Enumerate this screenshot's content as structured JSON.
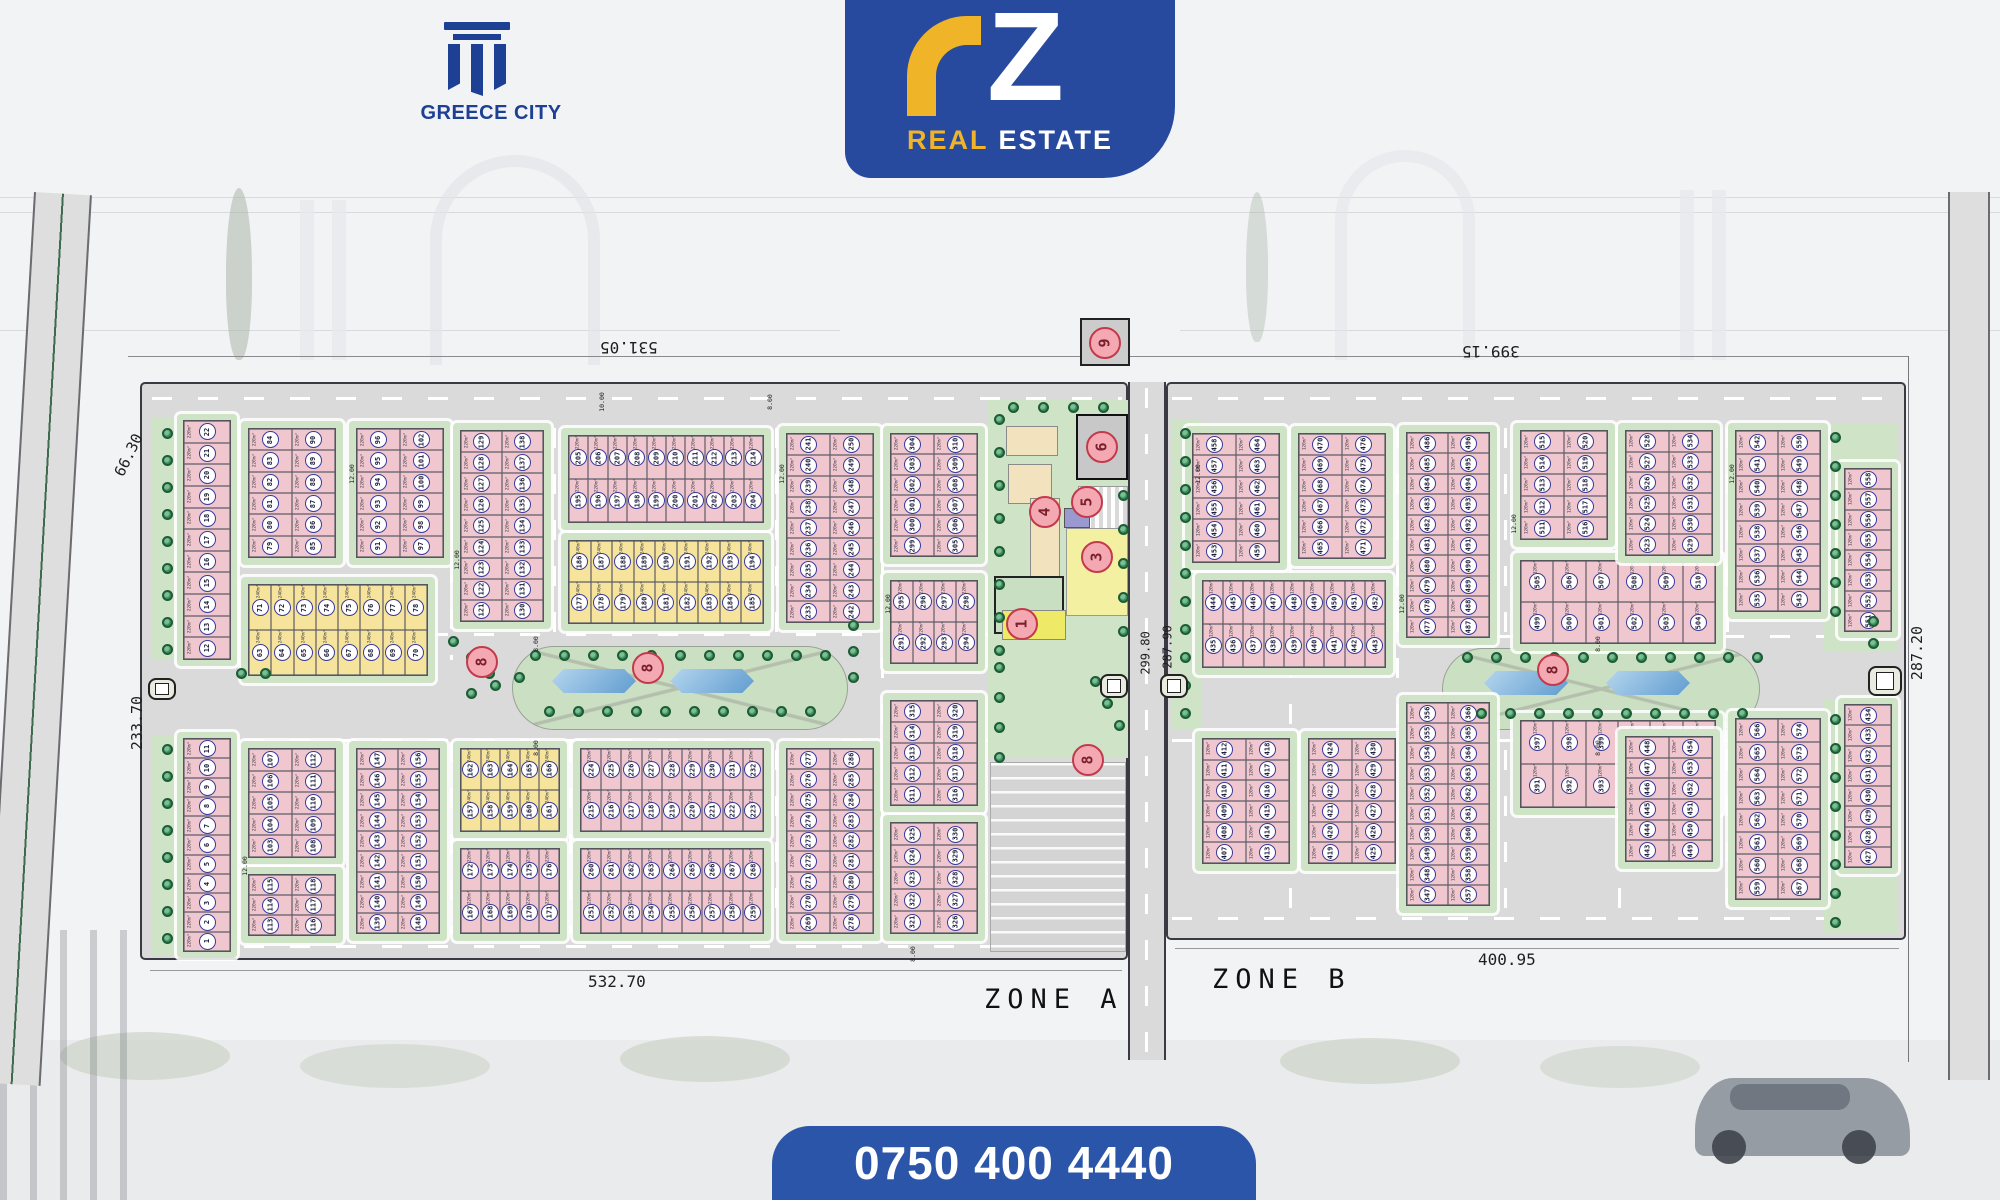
{
  "branding": {
    "developer": "GREECE CITY",
    "rz_z": "Z",
    "rz_real": "REAL",
    "rz_estate": "ESTATE",
    "phone": "0750 400 4440",
    "colors": {
      "brand_blue": "#274a9e",
      "brand_yellow": "#f0b428",
      "plot_pink": "#f1c7cf",
      "plot_yellow": "#f6e49c",
      "green": "#cfe3c6",
      "road": "#dadada",
      "lake_blue": "#5e9bcf",
      "marker_red": "#c23a4b"
    }
  },
  "plan": {
    "zone_labels": [
      {
        "t": "ZONE A",
        "x": 984,
        "y": 984
      },
      {
        "t": "ZONE B",
        "x": 1212,
        "y": 964
      }
    ],
    "dimensions": [
      {
        "t": "531.05",
        "x": 600,
        "y": 338,
        "r": 180,
        "s": 16
      },
      {
        "t": "399.15",
        "x": 1462,
        "y": 342,
        "r": 180,
        "s": 16
      },
      {
        "t": "66.30",
        "x": 106,
        "y": 446,
        "r": -64,
        "s": 15
      },
      {
        "t": "233.70",
        "x": 110,
        "y": 714,
        "r": -90,
        "s": 15
      },
      {
        "t": "287.20",
        "x": 1890,
        "y": 644,
        "r": -90,
        "s": 15
      },
      {
        "t": "299.80",
        "x": 1124,
        "y": 646,
        "r": -90,
        "s": 12
      },
      {
        "t": "287.90",
        "x": 1146,
        "y": 640,
        "r": -90,
        "s": 12
      },
      {
        "t": "532.70",
        "x": 588,
        "y": 972,
        "r": 0,
        "s": 16
      },
      {
        "t": "400.95",
        "x": 1478,
        "y": 950,
        "r": 0,
        "s": 16
      }
    ],
    "road_labels": [
      {
        "t": "10.00",
        "x": 592,
        "y": 398
      },
      {
        "t": "8.00",
        "x": 762,
        "y": 398
      },
      {
        "t": "8.00",
        "x": 528,
        "y": 640
      },
      {
        "t": "8.00",
        "x": 528,
        "y": 744
      },
      {
        "t": "8.00",
        "x": 905,
        "y": 950
      },
      {
        "t": "8.00",
        "x": 1590,
        "y": 640
      },
      {
        "t": "8.00",
        "x": 1590,
        "y": 744
      },
      {
        "t": "12.00",
        "x": 342,
        "y": 470
      },
      {
        "t": "12.00",
        "x": 447,
        "y": 556
      },
      {
        "t": "12.00",
        "x": 772,
        "y": 470
      },
      {
        "t": "12.00",
        "x": 878,
        "y": 600
      },
      {
        "t": "12.00",
        "x": 1188,
        "y": 470
      },
      {
        "t": "12.00",
        "x": 1392,
        "y": 600
      },
      {
        "t": "12.00",
        "x": 1722,
        "y": 470
      },
      {
        "t": "12.00",
        "x": 235,
        "y": 862
      },
      {
        "t": "12.00",
        "x": 1504,
        "y": 520
      }
    ],
    "dashes": [
      {
        "x": 152,
        "y": 397,
        "w": 970
      },
      {
        "x": 1172,
        "y": 397,
        "w": 726
      },
      {
        "x": 152,
        "y": 633,
        "w": 970
      },
      {
        "x": 152,
        "y": 739,
        "w": 970
      },
      {
        "x": 1172,
        "y": 635,
        "w": 726
      },
      {
        "x": 1172,
        "y": 739,
        "w": 726
      },
      {
        "x": 152,
        "y": 945,
        "w": 970
      },
      {
        "x": 1172,
        "y": 917,
        "w": 726
      },
      {
        "x": 1145,
        "y": 388,
        "h": 664,
        "v": 1
      },
      {
        "x": 450,
        "y": 425,
        "h": 235,
        "v": 1
      },
      {
        "x": 450,
        "y": 742,
        "h": 192,
        "v": 1
      },
      {
        "x": 553,
        "y": 428,
        "h": 228,
        "v": 1
      },
      {
        "x": 569,
        "y": 742,
        "h": 192,
        "v": 1
      },
      {
        "x": 775,
        "y": 428,
        "h": 506,
        "v": 1
      },
      {
        "x": 881,
        "y": 428,
        "h": 506,
        "v": 1
      },
      {
        "x": 1289,
        "y": 428,
        "h": 506,
        "v": 1
      },
      {
        "x": 1396,
        "y": 428,
        "h": 506,
        "v": 1
      },
      {
        "x": 1504,
        "y": 428,
        "h": 506,
        "v": 1
      },
      {
        "x": 1618,
        "y": 428,
        "h": 506,
        "v": 1
      },
      {
        "x": 1726,
        "y": 428,
        "h": 506,
        "v": 1
      }
    ],
    "medians": [
      {
        "x": 512,
        "y": 646,
        "w": 336,
        "h": 84,
        "lakes": [
          {
            "x": 552,
            "y": 666,
            "w": 84,
            "h": 30
          },
          {
            "x": 670,
            "y": 666,
            "w": 84,
            "h": 30
          }
        ]
      },
      {
        "x": 1442,
        "y": 648,
        "w": 318,
        "h": 82,
        "lakes": [
          {
            "x": 1484,
            "y": 668,
            "w": 84,
            "h": 30
          },
          {
            "x": 1606,
            "y": 668,
            "w": 84,
            "h": 30
          }
        ]
      }
    ],
    "facilities": [
      {
        "name": "green-strip",
        "x": 152,
        "y": 418,
        "w": 30,
        "h": 242,
        "bg": "#cfe4c7"
      },
      {
        "name": "green-strip",
        "x": 152,
        "y": 736,
        "w": 30,
        "h": 220,
        "bg": "#cfe4c7"
      },
      {
        "name": "green-strip",
        "x": 1172,
        "y": 420,
        "w": 30,
        "h": 310,
        "bg": "#cfe4c7"
      },
      {
        "name": "green-strip",
        "x": 1824,
        "y": 424,
        "w": 74,
        "h": 228,
        "bg": "#cfe4c7"
      },
      {
        "name": "green-strip",
        "x": 1824,
        "y": 700,
        "w": 74,
        "h": 234,
        "bg": "#cfe4c7"
      },
      {
        "name": "services-green",
        "x": 988,
        "y": 400,
        "w": 140,
        "h": 358,
        "bg": "#cfe4c7"
      },
      {
        "name": "parking-area",
        "x": 990,
        "y": 762,
        "w": 136,
        "h": 190,
        "bg": "#d6d6d6",
        "bd": "#aaa",
        "hatch": 1
      },
      {
        "name": "service-building",
        "x": 1006,
        "y": 426,
        "w": 52,
        "h": 30,
        "bg": "#f2e2bd",
        "bd": "#8a8a8a"
      },
      {
        "name": "service-building",
        "x": 1008,
        "y": 464,
        "w": 44,
        "h": 40,
        "bg": "#f2e2bd",
        "bd": "#8a8a8a"
      },
      {
        "name": "service-building",
        "x": 1030,
        "y": 498,
        "w": 30,
        "h": 96,
        "bg": "#f2e2bd",
        "bd": "#8a8a8a"
      },
      {
        "name": "electrical-station",
        "x": 1076,
        "y": 414,
        "w": 52,
        "h": 66,
        "bg": "#c8c8c8",
        "bd": "#111",
        "bw": 2
      },
      {
        "name": "striped-court",
        "x": 1078,
        "y": 486,
        "w": 50,
        "h": 52,
        "bg": "repeating-linear-gradient(90deg,#ffffff 0 4px,#d9d9d9 4px 8px)",
        "bd": "#999"
      },
      {
        "name": "service-building",
        "x": 1064,
        "y": 508,
        "w": 26,
        "h": 20,
        "bg": "#9a9ad0",
        "bd": "#555"
      },
      {
        "name": "service-building",
        "x": 1066,
        "y": 528,
        "w": 62,
        "h": 88,
        "bg": "#f4f0a2",
        "bd": "#999"
      },
      {
        "name": "walled-garden",
        "x": 994,
        "y": 576,
        "w": 70,
        "h": 58,
        "bg": "#c9dfc1",
        "bd": "#222",
        "bw": 2
      },
      {
        "name": "service-building",
        "x": 1002,
        "y": 610,
        "w": 64,
        "h": 30,
        "bg": "#eeea67",
        "bd": "#888"
      },
      {
        "name": "service-building",
        "x": 1080,
        "y": 318,
        "w": 50,
        "h": 48,
        "bg": "#cccccc",
        "bd": "#222",
        "bw": 2
      }
    ],
    "blocks": [
      {
        "x": 248,
        "y": 428,
        "w": 88,
        "h": 130,
        "t": "v",
        "n": 6,
        "s": 79,
        "a": "220m²",
        "c": "p"
      },
      {
        "x": 356,
        "y": 428,
        "w": 88,
        "h": 130,
        "t": "v",
        "n": 6,
        "s": 91,
        "a": "220m²",
        "c": "p"
      },
      {
        "x": 248,
        "y": 584,
        "w": 180,
        "h": 92,
        "t": "h",
        "n": 8,
        "s": 63,
        "a": "240m²",
        "c": "y"
      },
      {
        "x": 460,
        "y": 430,
        "w": 84,
        "h": 192,
        "t": "v",
        "n": 9,
        "s": 121,
        "a": "220m²",
        "c": "p"
      },
      {
        "x": 568,
        "y": 435,
        "w": 196,
        "h": 88,
        "t": "h",
        "n": 10,
        "s": 195,
        "a": "220m²",
        "c": "p"
      },
      {
        "x": 568,
        "y": 540,
        "w": 196,
        "h": 84,
        "t": "h",
        "n": 9,
        "s": 177,
        "a": "240m²",
        "c": "y"
      },
      {
        "x": 786,
        "y": 433,
        "w": 88,
        "h": 190,
        "t": "v",
        "n": 9,
        "s": 233,
        "a": "220m²",
        "c": "p"
      },
      {
        "x": 890,
        "y": 433,
        "w": 88,
        "h": 124,
        "t": "v",
        "n": 6,
        "s": 299,
        "a": "220m²",
        "c": "p"
      },
      {
        "x": 890,
        "y": 580,
        "w": 88,
        "h": 84,
        "t": "h",
        "n": 4,
        "s": 291,
        "a": "220m²",
        "c": "p"
      },
      {
        "x": 248,
        "y": 748,
        "w": 88,
        "h": 110,
        "t": "v",
        "n": 5,
        "s": 103,
        "a": "220m²",
        "c": "p"
      },
      {
        "x": 248,
        "y": 874,
        "w": 88,
        "h": 62,
        "t": "v",
        "n": 3,
        "s": 113,
        "a": "220m²",
        "c": "p"
      },
      {
        "x": 356,
        "y": 748,
        "w": 84,
        "h": 186,
        "t": "v",
        "n": 9,
        "s": 139,
        "a": "220m²",
        "c": "p"
      },
      {
        "x": 460,
        "y": 748,
        "w": 100,
        "h": 84,
        "t": "h",
        "n": 5,
        "s": 157,
        "a": "240m²",
        "c": "y"
      },
      {
        "x": 460,
        "y": 848,
        "w": 100,
        "h": 86,
        "t": "h",
        "n": 5,
        "s": 167,
        "a": "220m²",
        "c": "p"
      },
      {
        "x": 580,
        "y": 748,
        "w": 184,
        "h": 84,
        "t": "h",
        "n": 9,
        "s": 215,
        "a": "220m²",
        "c": "p"
      },
      {
        "x": 580,
        "y": 848,
        "w": 184,
        "h": 86,
        "t": "h",
        "n": 9,
        "s": 251,
        "a": "220m²",
        "c": "p"
      },
      {
        "x": 786,
        "y": 748,
        "w": 88,
        "h": 186,
        "t": "v",
        "n": 9,
        "s": 269,
        "a": "220m²",
        "c": "p"
      },
      {
        "x": 890,
        "y": 700,
        "w": 88,
        "h": 106,
        "t": "v",
        "n": 5,
        "s": 311,
        "a": "220m²",
        "c": "p"
      },
      {
        "x": 890,
        "y": 822,
        "w": 88,
        "h": 112,
        "t": "v",
        "n": 5,
        "s": 321,
        "a": "220m²",
        "c": "p"
      },
      {
        "x": 1192,
        "y": 433,
        "w": 88,
        "h": 130,
        "t": "v",
        "n": 6,
        "s": 453,
        "a": "120m²",
        "c": "p"
      },
      {
        "x": 1298,
        "y": 433,
        "w": 88,
        "h": 126,
        "t": "v",
        "n": 6,
        "s": 465,
        "a": "120m²",
        "c": "p"
      },
      {
        "x": 1406,
        "y": 432,
        "w": 84,
        "h": 206,
        "t": "v",
        "n": 10,
        "s": 477,
        "a": "120m²",
        "c": "p"
      },
      {
        "x": 1202,
        "y": 580,
        "w": 184,
        "h": 88,
        "t": "h",
        "n": 9,
        "s": 435,
        "a": "120m²",
        "c": "p"
      },
      {
        "x": 1520,
        "y": 560,
        "w": 196,
        "h": 84,
        "t": "h",
        "n": 6,
        "s": 499,
        "a": "120m²",
        "c": "p"
      },
      {
        "x": 1520,
        "y": 430,
        "w": 88,
        "h": 110,
        "t": "v",
        "n": 5,
        "s": 511,
        "a": "120m²",
        "c": "p"
      },
      {
        "x": 1625,
        "y": 430,
        "w": 88,
        "h": 126,
        "t": "v",
        "n": 6,
        "s": 523,
        "a": "120m²",
        "c": "p"
      },
      {
        "x": 1735,
        "y": 430,
        "w": 86,
        "h": 182,
        "t": "v",
        "n": 8,
        "s": 535,
        "a": "120m²",
        "c": "p"
      },
      {
        "x": 1202,
        "y": 738,
        "w": 88,
        "h": 126,
        "t": "v",
        "n": 6,
        "s": 407,
        "a": "120m²",
        "c": "p"
      },
      {
        "x": 1308,
        "y": 738,
        "w": 88,
        "h": 126,
        "t": "v",
        "n": 6,
        "s": 419,
        "a": "120m²",
        "c": "p"
      },
      {
        "x": 1406,
        "y": 702,
        "w": 84,
        "h": 204,
        "t": "v",
        "n": 10,
        "s": 347,
        "a": "120m²",
        "c": "p"
      },
      {
        "x": 1520,
        "y": 720,
        "w": 196,
        "h": 88,
        "t": "h",
        "n": 6,
        "s": 391,
        "a": "120m²",
        "c": "p"
      },
      {
        "x": 1625,
        "y": 736,
        "w": 88,
        "h": 126,
        "t": "v",
        "n": 6,
        "s": 443,
        "a": "120m²",
        "c": "p"
      },
      {
        "x": 1735,
        "y": 718,
        "w": 86,
        "h": 182,
        "t": "v",
        "n": 8,
        "s": 559,
        "a": "120m²",
        "c": "p"
      }
    ],
    "edge_strips": [
      {
        "x": 183,
        "y": 420,
        "w": 48,
        "h": 240,
        "n": 11,
        "s": 12,
        "a": "220m²"
      },
      {
        "x": 183,
        "y": 738,
        "w": 48,
        "h": 214,
        "n": 11,
        "s": 1,
        "a": "220m²"
      },
      {
        "x": 1844,
        "y": 468,
        "w": 48,
        "h": 164,
        "n": 8,
        "s": 551,
        "a": "120m²"
      },
      {
        "x": 1844,
        "y": 704,
        "w": 48,
        "h": 164,
        "n": 8,
        "s": 427,
        "a": "120m²"
      }
    ],
    "tree_strips": [
      {
        "x": 162,
        "y": 428,
        "dy": 27,
        "n": 9
      },
      {
        "x": 162,
        "y": 744,
        "dy": 27,
        "n": 8
      },
      {
        "x": 994,
        "y": 414,
        "dy": 33,
        "n": 8
      },
      {
        "x": 994,
        "y": 662,
        "dy": 30,
        "n": 4
      },
      {
        "x": 1118,
        "y": 490,
        "dy": 34,
        "n": 5
      },
      {
        "x": 1008,
        "y": 402,
        "dx": 30,
        "n": 4
      },
      {
        "x": 1180,
        "y": 428,
        "dy": 28,
        "n": 11
      },
      {
        "x": 1830,
        "y": 432,
        "dy": 29,
        "n": 7
      },
      {
        "x": 1830,
        "y": 714,
        "dy": 29,
        "n": 8
      },
      {
        "x": 530,
        "y": 650,
        "dx": 29,
        "n": 11
      },
      {
        "x": 544,
        "y": 706,
        "dx": 29,
        "n": 10
      },
      {
        "x": 1462,
        "y": 652,
        "dx": 29,
        "n": 11
      },
      {
        "x": 1476,
        "y": 708,
        "dx": 29,
        "n": 10
      },
      {
        "x": 448,
        "y": 636,
        "dx": 18,
        "dy": 16,
        "n": 3
      },
      {
        "x": 466,
        "y": 688,
        "dx": 24,
        "dy": -8,
        "n": 3
      },
      {
        "x": 848,
        "y": 620,
        "dy": 26,
        "n": 3
      },
      {
        "x": 1090,
        "y": 676,
        "dx": 12,
        "dy": 22,
        "n": 3
      },
      {
        "x": 1868,
        "y": 616,
        "dy": 22,
        "n": 2
      },
      {
        "x": 236,
        "y": 668,
        "dx": 24,
        "n": 2
      }
    ],
    "gates": [
      {
        "x": 148,
        "y": 678,
        "w": 28,
        "h": 22
      },
      {
        "x": 1868,
        "y": 666,
        "w": 34,
        "h": 30
      },
      {
        "x": 1100,
        "y": 674,
        "w": 28,
        "h": 24
      },
      {
        "x": 1160,
        "y": 674,
        "w": 28,
        "h": 24
      }
    ],
    "markers": [
      {
        "n": "9",
        "cx": 1105,
        "cy": 343
      },
      {
        "n": "6",
        "cx": 1102,
        "cy": 447
      },
      {
        "n": "5",
        "cx": 1087,
        "cy": 502
      },
      {
        "n": "4",
        "cx": 1045,
        "cy": 512
      },
      {
        "n": "3",
        "cx": 1097,
        "cy": 557
      },
      {
        "n": "1",
        "cx": 1022,
        "cy": 624
      },
      {
        "n": "8",
        "cx": 1088,
        "cy": 760
      },
      {
        "n": "8",
        "cx": 482,
        "cy": 662
      },
      {
        "n": "8",
        "cx": 648,
        "cy": 668
      },
      {
        "n": "8",
        "cx": 1553,
        "cy": 670
      }
    ]
  }
}
